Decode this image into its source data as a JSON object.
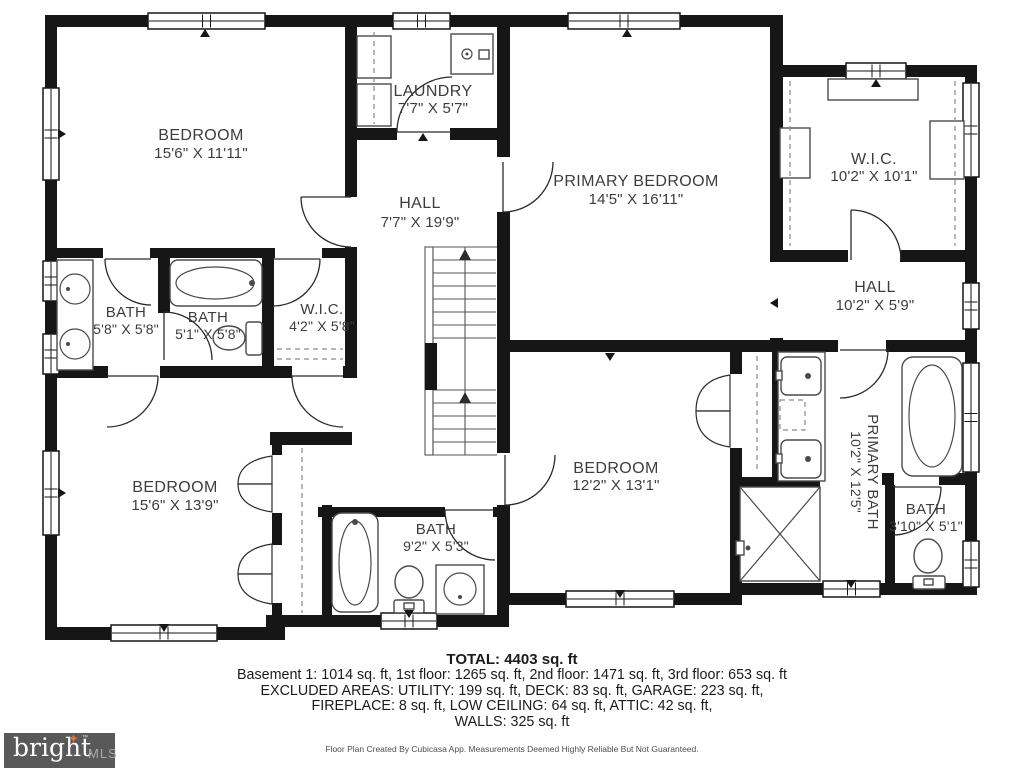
{
  "plan": {
    "rooms": [
      {
        "name": "BEDROOM",
        "dims": "15'6\" X 11'11\""
      },
      {
        "name": "LAUNDRY",
        "dims": "7'7\" X 5'7\""
      },
      {
        "name": "HALL",
        "dims": "7'7\" X 19'9\""
      },
      {
        "name": "PRIMARY BEDROOM",
        "dims": "14'5\" X 16'11\""
      },
      {
        "name": "W.I.C.",
        "dims": "10'2\" X 10'1\""
      },
      {
        "name": "HALL",
        "dims": "10'2\" X 5'9\""
      },
      {
        "name": "BATH",
        "dims": "5'8\" X 5'8\""
      },
      {
        "name": "BATH",
        "dims": "5'1\" X 5'8\""
      },
      {
        "name": "W.I.C.",
        "dims": "4'2\" X 5'8\""
      },
      {
        "name": "BEDROOM",
        "dims": "15'6\" X 13'9\""
      },
      {
        "name": "BATH",
        "dims": "9'2\" X 5'3\""
      },
      {
        "name": "BEDROOM",
        "dims": "12'2\" X 13'1\""
      },
      {
        "name": "PRIMARY BATH",
        "dims": "10'2\" X 12'5\""
      },
      {
        "name": "BATH",
        "dims": "3'10\" X 5'1\""
      }
    ]
  },
  "summary": {
    "total": "TOTAL: 4403 sq. ft",
    "floors": "Basement 1: 1014 sq. ft, 1st floor: 1265 sq. ft, 2nd floor: 1471 sq. ft, 3rd floor: 653 sq. ft",
    "excluded1": "EXCLUDED AREAS: UTILITY: 199 sq. ft, DECK: 83 sq. ft, GARAGE: 223 sq. ft,",
    "excluded2": "FIREPLACE: 8 sq. ft, LOW CEILING: 64 sq. ft, ATTIC: 42 sq. ft,",
    "walls": "WALLS: 325 sq. ft"
  },
  "footer": {
    "disclaimer": "Floor Plan Created By Cubicasa App. Measurements Deemed Highly Reliable But Not Guaranteed.",
    "logo": {
      "brand": "bright",
      "star": "✦",
      "tm": "™",
      "suffix": "MLS"
    }
  }
}
